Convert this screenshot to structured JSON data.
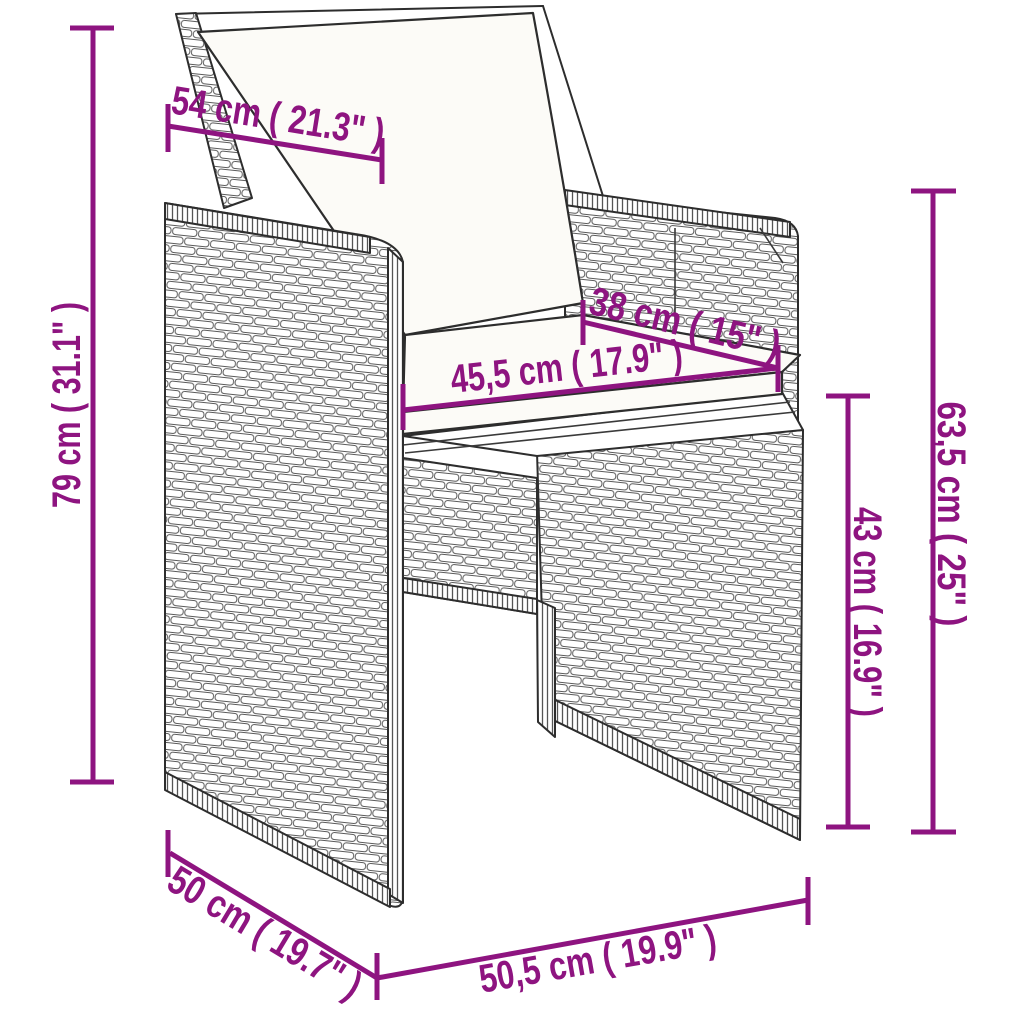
{
  "diagram": {
    "subject": "rattan chair with back and seat cushions, annotated dimension drawing",
    "colors": {
      "dimension_accent": "#8E1480",
      "line_art": "#2d2d2d",
      "weave_line": "#5a5a5a",
      "cushion_fill": "#FCFBF7",
      "background": "#FFFFFF"
    },
    "dimensions": [
      {
        "id": "backrest-width",
        "label": "54 cm ( 21.3\" )",
        "cm": "54",
        "inch": "21.3"
      },
      {
        "id": "total-height",
        "label": "79 cm ( 31.1\" )",
        "cm": "79",
        "inch": "31.1"
      },
      {
        "id": "seat-depth",
        "label": "38 cm ( 15\" )",
        "cm": "38",
        "inch": "15"
      },
      {
        "id": "seat-width",
        "label": "45,5 cm ( 17.9\" )",
        "cm": "45,5",
        "inch": "17.9"
      },
      {
        "id": "seat-height",
        "label": "43 cm ( 16.9\" )",
        "cm": "43",
        "inch": "16.9"
      },
      {
        "id": "armrest-height",
        "label": "63,5 cm ( 25\" )",
        "cm": "63,5",
        "inch": "25"
      },
      {
        "id": "total-depth",
        "label": "50 cm ( 19.7\" )",
        "cm": "50",
        "inch": "19.7"
      },
      {
        "id": "total-width",
        "label": "50,5 cm ( 19.9\" )",
        "cm": "50,5",
        "inch": "19.9"
      }
    ]
  }
}
